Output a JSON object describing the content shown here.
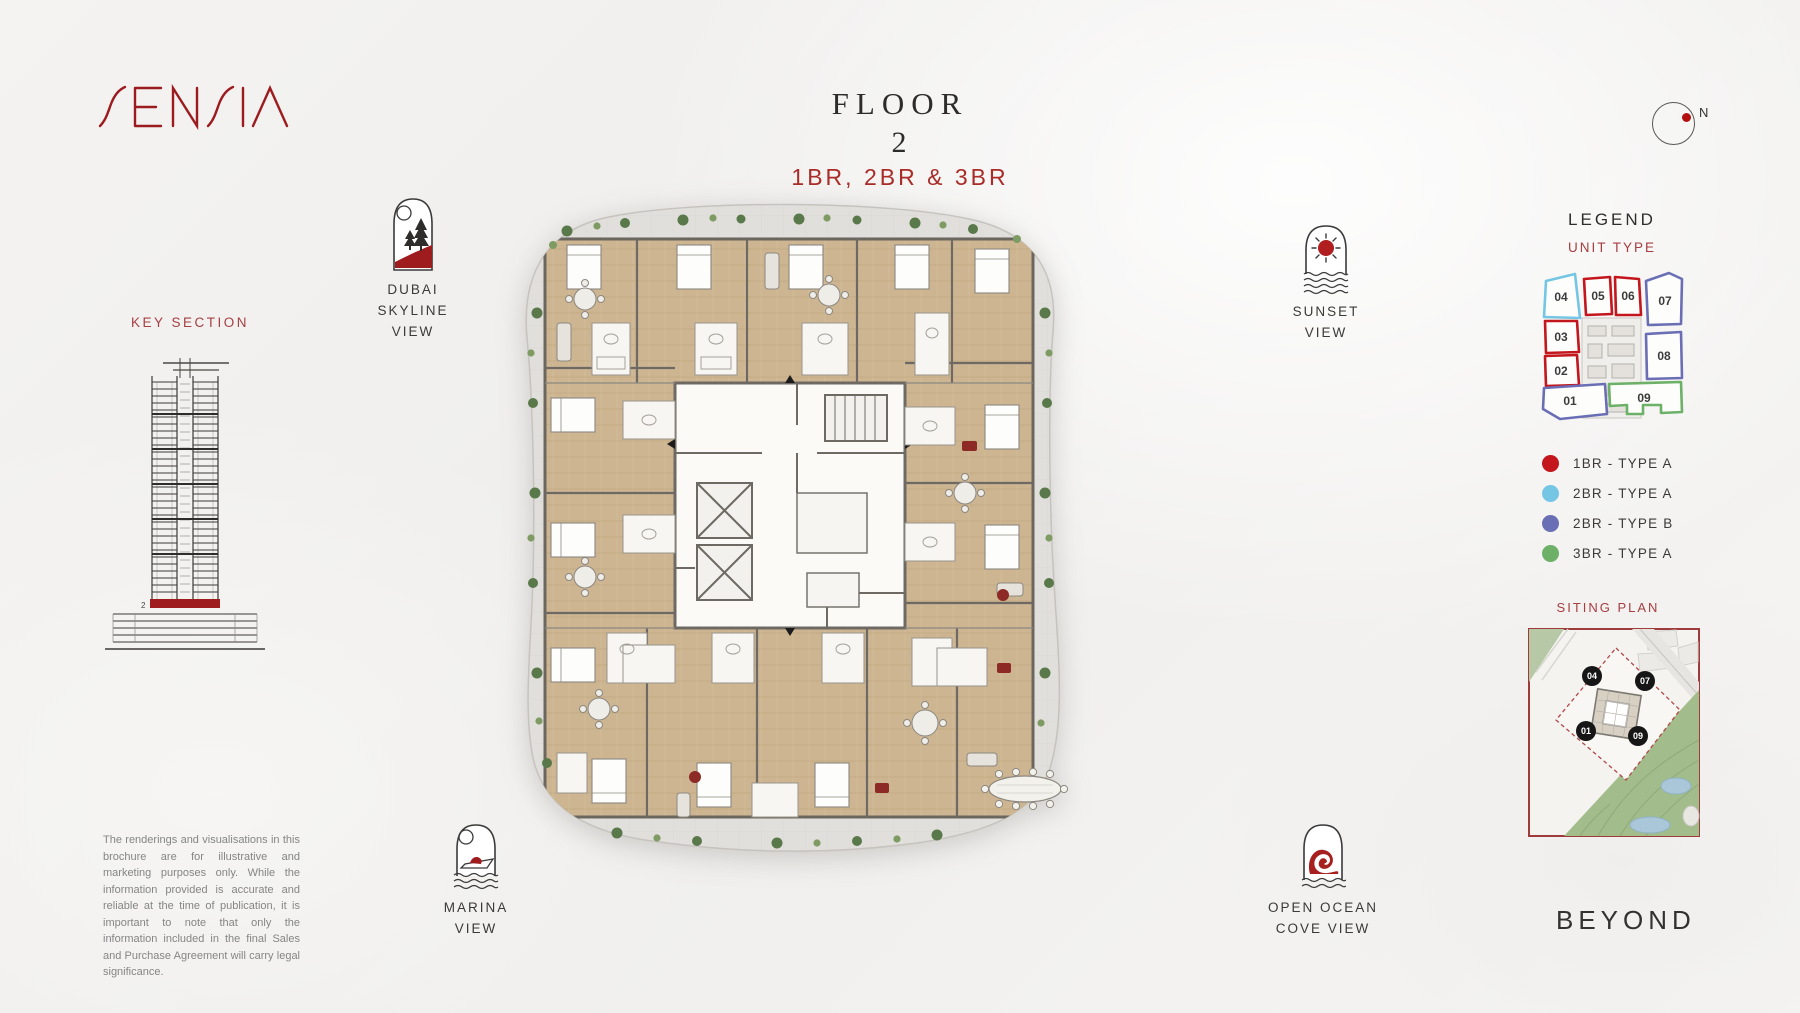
{
  "brand": {
    "name": "SENSIA",
    "logo_color": "#9c1b1f"
  },
  "header": {
    "title": "FLOOR",
    "floor_number": "2",
    "subtitle": "1BR, 2BR & 3BR"
  },
  "compass": {
    "label": "N"
  },
  "key_section": {
    "title": "KEY SECTION",
    "floor_marker": "2",
    "highlight_color": "#9e1b1e"
  },
  "views": {
    "dubai_skyline": {
      "line1": "DUBAI",
      "line2": "SKYLINE",
      "line3": "VIEW"
    },
    "sunset": {
      "line1": "SUNSET",
      "line2": "VIEW"
    },
    "marina": {
      "line1": "MARINA",
      "line2": "VIEW"
    },
    "open_ocean": {
      "line1": "OPEN OCEAN",
      "line2": "COVE VIEW"
    }
  },
  "legend": {
    "title": "LEGEND",
    "subtitle": "UNIT TYPE",
    "units": [
      {
        "number": "04",
        "type": "2BR - TYPE A",
        "color": "#74c6e4"
      },
      {
        "number": "05",
        "type": "1BR - TYPE A",
        "color": "#c3161d"
      },
      {
        "number": "06",
        "type": "1BR - TYPE A",
        "color": "#c3161d"
      },
      {
        "number": "07",
        "type": "2BR - TYPE B",
        "color": "#6a6fb5"
      },
      {
        "number": "03",
        "type": "1BR - TYPE A",
        "color": "#c3161d"
      },
      {
        "number": "02",
        "type": "1BR - TYPE A",
        "color": "#c3161d"
      },
      {
        "number": "08",
        "type": "2BR - TYPE B",
        "color": "#6a6fb5"
      },
      {
        "number": "01",
        "type": "2BR - TYPE B",
        "color": "#6a6fb5"
      },
      {
        "number": "09",
        "type": "3BR - TYPE A",
        "color": "#6cb167"
      }
    ],
    "entries": [
      {
        "label": "1BR - TYPE A",
        "color": "#c3161d"
      },
      {
        "label": "2BR - TYPE A",
        "color": "#74c6e4"
      },
      {
        "label": "2BR - TYPE B",
        "color": "#6a6fb5"
      },
      {
        "label": "3BR - TYPE A",
        "color": "#6cb167"
      }
    ]
  },
  "siting_plan": {
    "title": "SITING PLAN",
    "markers": [
      "04",
      "07",
      "01",
      "09"
    ]
  },
  "footer": {
    "developer": "BEYOND"
  },
  "disclaimer": "The renderings and visualisations in this brochure are for illustrative and marketing purposes only. While the information provided is accurate and reliable at the time of publication, it is important to note that only the information included in the final Sales and Purchase Agreement will carry legal significance."
}
